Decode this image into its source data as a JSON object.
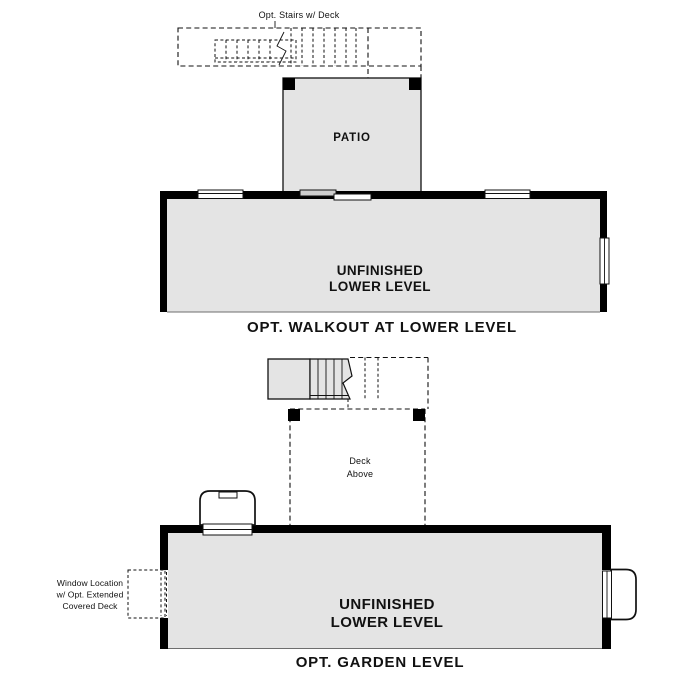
{
  "colors": {
    "floor_fill": "#e4e4e4",
    "door_panel_fill": "#cfcfcf",
    "wall": "#000000"
  },
  "walkout_plan": {
    "stairs_note": "Opt. Stairs w/ Deck",
    "patio_label": "PATIO",
    "room_label": [
      "UNFINISHED",
      "LOWER LEVEL"
    ],
    "caption": "OPT. WALKOUT AT LOWER LEVEL"
  },
  "garden_plan": {
    "deck_note": [
      "Deck",
      "Above"
    ],
    "window_note": [
      "Window Location",
      "w/ Opt. Extended",
      "Covered Deck"
    ],
    "room_label": [
      "UNFINISHED",
      "LOWER LEVEL"
    ],
    "caption": "OPT. GARDEN LEVEL"
  }
}
